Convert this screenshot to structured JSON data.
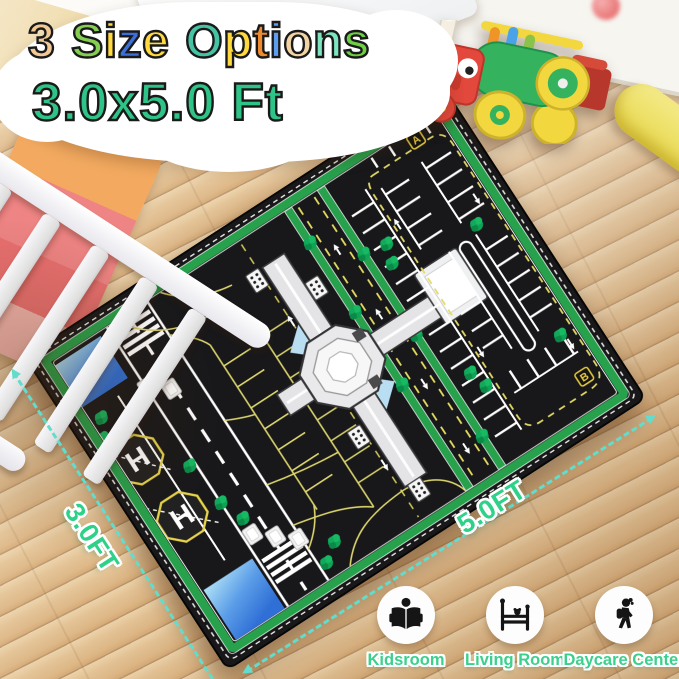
{
  "title": {
    "line1_text": "3 Size Options",
    "line1_letters": [
      {
        "ch": "3",
        "color": "#f2c995"
      },
      {
        "ch": " ",
        "color": ""
      },
      {
        "ch": "S",
        "color": "#84cf52"
      },
      {
        "ch": "i",
        "color": "#ffd93d"
      },
      {
        "ch": "z",
        "color": "#3e6fd9"
      },
      {
        "ch": "e",
        "color": "#ffd93d"
      },
      {
        "ch": " ",
        "color": ""
      },
      {
        "ch": "O",
        "color": "#45c3a4"
      },
      {
        "ch": "p",
        "color": "#ffd93d"
      },
      {
        "ch": "t",
        "color": "#ef8b2e"
      },
      {
        "ch": "i",
        "color": "#5d9cf0"
      },
      {
        "ch": "o",
        "color": "#f2d4a4"
      },
      {
        "ch": "n",
        "color": "#7de5c0"
      },
      {
        "ch": "s",
        "color": "#6ecf44"
      }
    ],
    "line2": "3.0x5.0 Ft",
    "line2_color": "#2ec487"
  },
  "dimensions": {
    "width_label": "3.0FT",
    "length_label": "5.0FT",
    "label_color": "#2ed188",
    "arrow_color": "#62dccb"
  },
  "mat": {
    "marker_a": "A",
    "marker_b": "B",
    "helipad_letter": "H",
    "border_color": "#27a14c",
    "surface_color": "#18181a",
    "lane_yellow": "#e8df62",
    "line_white": "#ffffff",
    "pond_blue": "#5c9ee8",
    "tree_green": "#0ea355"
  },
  "rooms": [
    {
      "label": "Kidsroom",
      "icon": "reading-child-icon"
    },
    {
      "label": "Living Room",
      "icon": "bed-icon"
    },
    {
      "label": "Daycare Center",
      "icon": "walking-child-icon"
    }
  ]
}
